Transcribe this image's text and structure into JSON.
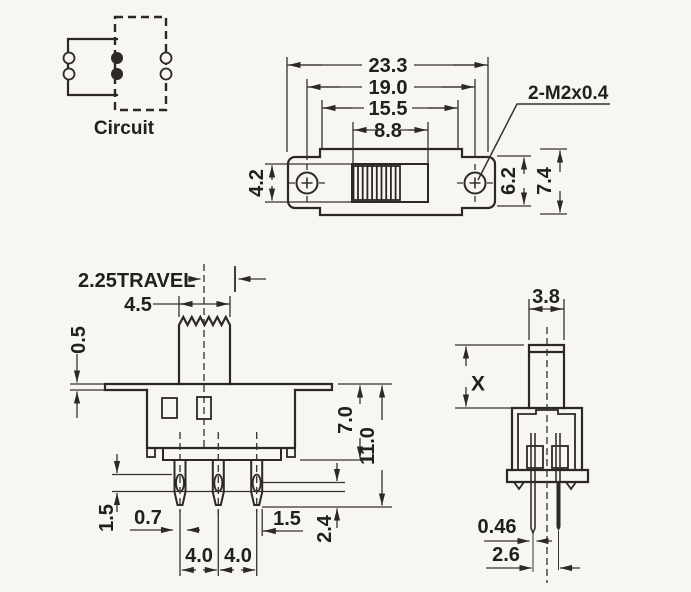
{
  "title": "Slide switch mechanical drawing",
  "ink": "#2b2825",
  "background": "#f7f6f3",
  "circuit": {
    "label": "Circuit"
  },
  "top_view": {
    "dims": {
      "d233": "23.3",
      "d190": "19.0",
      "d155": "15.5",
      "d88": "8.8",
      "d42": "4.2",
      "d62": "6.2",
      "d74": "7.4"
    },
    "thread_note": "2-M2x0.4"
  },
  "front_view": {
    "dims": {
      "travel": "2.25TRAVEL",
      "d45": "4.5",
      "d05": "0.5",
      "d70": "7.0",
      "d110": "11.0",
      "d15_left": "1.5",
      "d07": "0.7",
      "d40_left": "4.0",
      "d40_right": "4.0",
      "d15_right": "1.5",
      "d24": "2.4"
    }
  },
  "side_view": {
    "dims": {
      "d38": "3.8",
      "dx": "X",
      "d046": "0.46",
      "d26": "2.6"
    }
  }
}
